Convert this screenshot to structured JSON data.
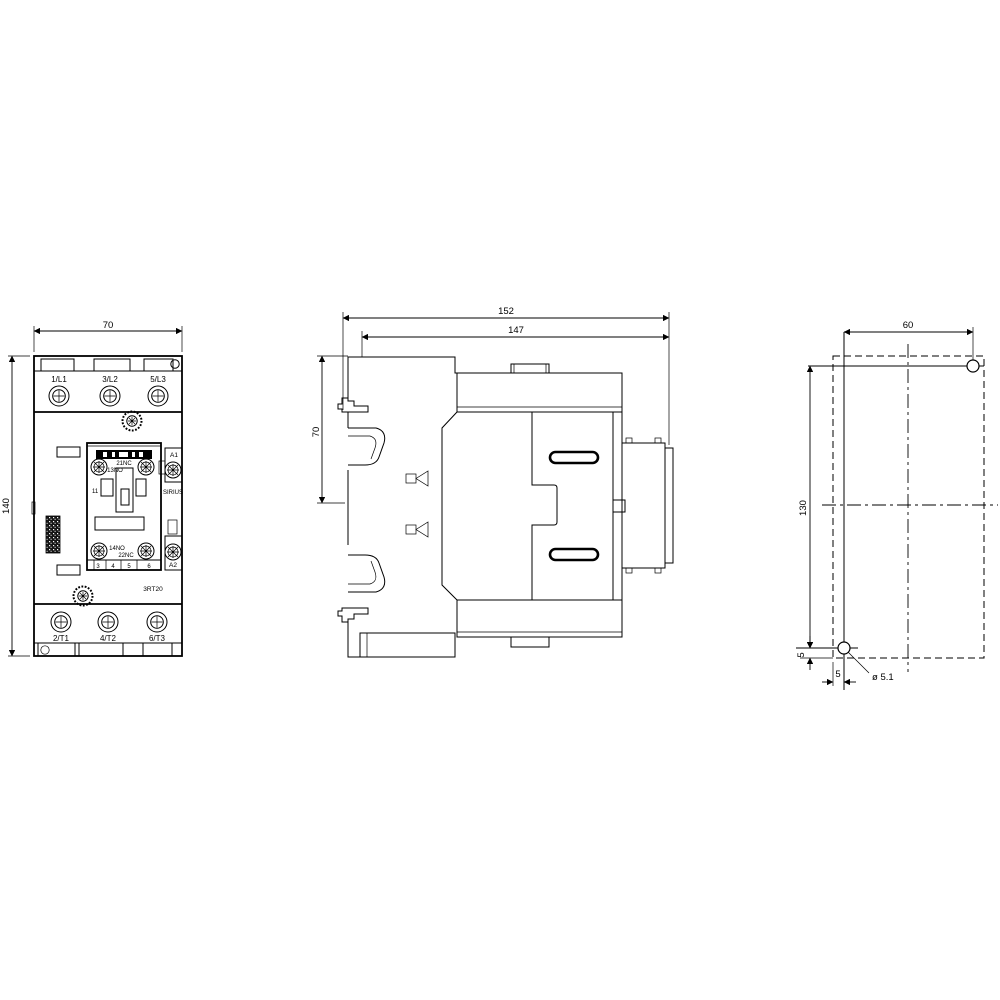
{
  "title": "contactor-dimension-drawing",
  "front_view": {
    "dim_width": "70",
    "dim_height": "140",
    "terminals_top": [
      "1/L1",
      "3/L2",
      "5/L3"
    ],
    "terminals_bottom": [
      "2/T1",
      "4/T2",
      "6/T3"
    ],
    "aux": {
      "top_line1": "21NC",
      "top_line2": "13NO",
      "bottom_line1": "14NO",
      "bottom_line2": "22NC",
      "left_terminal": "11",
      "slot_numbers": [
        "3",
        "4",
        "5",
        "6"
      ]
    },
    "coil": {
      "a1": "A1",
      "a2": "A2"
    },
    "brand": "SIRIUS",
    "model": "3RT20"
  },
  "side_view": {
    "dim_total_depth": "152",
    "dim_body_depth": "147",
    "dim_top_to_rail": "70"
  },
  "mounting_view": {
    "dim_holes_horizontal": "60",
    "dim_holes_vertical": "130",
    "dim_bottom_offset": "5",
    "dim_side_offset": "5",
    "hole_diameter_label": "ø 5.1"
  },
  "colors": {
    "line": "#000000",
    "background": "#ffffff"
  }
}
